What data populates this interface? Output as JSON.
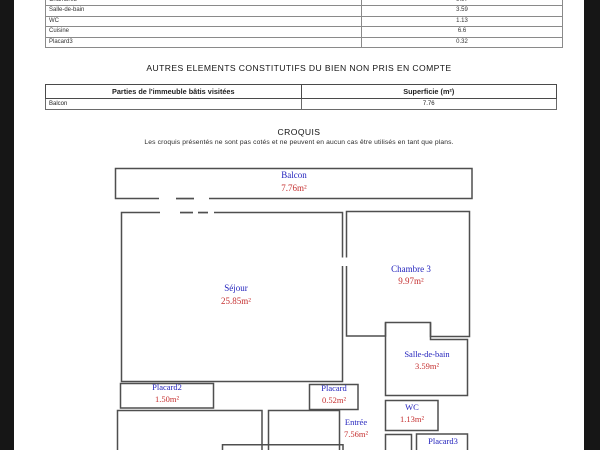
{
  "document": {
    "background": "#ffffff",
    "margin_color": "#161616"
  },
  "surface_table": {
    "rows": [
      {
        "label": "Chambre3",
        "value": "9.97"
      },
      {
        "label": "Salle-de-bain",
        "value": "3.59"
      },
      {
        "label": "WC",
        "value": "1.13"
      },
      {
        "label": "Cuisine",
        "value": "6.6"
      },
      {
        "label": "Placard3",
        "value": "0.32"
      }
    ]
  },
  "autres_section": {
    "title": "AUTRES ELEMENTS CONSTITUTIFS DU BIEN NON PRIS EN COMPTE",
    "table": {
      "header_parties": "Parties de l'immeuble bâtis visitées",
      "header_superficie": "Superficie (m²)",
      "rows": [
        {
          "label": "Balcon",
          "value": "7.76"
        }
      ]
    }
  },
  "croquis_section": {
    "title": "CROQUIS",
    "note": "Les croquis présentés ne sont pas cotés et ne peuvent en aucun cas être utilisés en tant que plans."
  },
  "floorplan": {
    "colors": {
      "room_name": "#2323bd",
      "room_area": "#c53030",
      "walls": "#4f4f4f"
    },
    "rooms": [
      {
        "name": "Balcon",
        "area": "7.76m²"
      },
      {
        "name": "Séjour",
        "area": "25.85m²"
      },
      {
        "name": "Chambre 3",
        "area": "9.97m²"
      },
      {
        "name": "Salle-de-bain",
        "area": "3.59m²"
      },
      {
        "name": "WC",
        "area": "1.13m²"
      },
      {
        "name": "Placard2",
        "area": "1.50m²"
      },
      {
        "name": "Placard",
        "area": "0.52m²"
      },
      {
        "name": "Entrée",
        "area": "7.56m²"
      },
      {
        "name": "Placard3",
        "area": ""
      }
    ]
  }
}
